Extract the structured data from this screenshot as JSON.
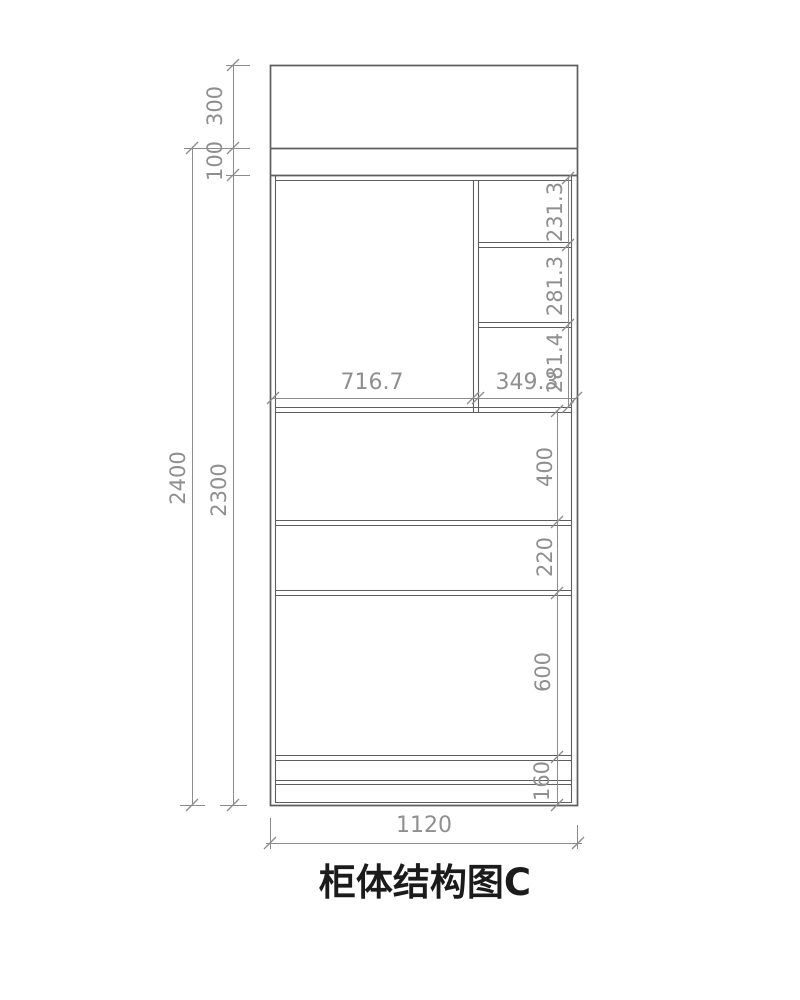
{
  "title": "柜体结构图C",
  "colors": {
    "background": "#ffffff",
    "line": "#5e5e5e",
    "dim_line": "#8c8c8c",
    "dim_text": "#8f8f8f",
    "title_text": "#1b1b1b"
  },
  "dimensions": {
    "overall_height": "2400",
    "carcass_height": "2300",
    "top_section_height": "300",
    "top_gap_height": "100",
    "upper_left_width": "716.7",
    "upper_right_width": "349.3",
    "right_cell_top": "231.3",
    "right_cell_middle": "281.3",
    "right_cell_bottom": "281.4",
    "section_above_first_shelf": "400",
    "section_between_shelves": "220",
    "section_lower": "600",
    "base_height": "160",
    "overall_width": "1120"
  }
}
